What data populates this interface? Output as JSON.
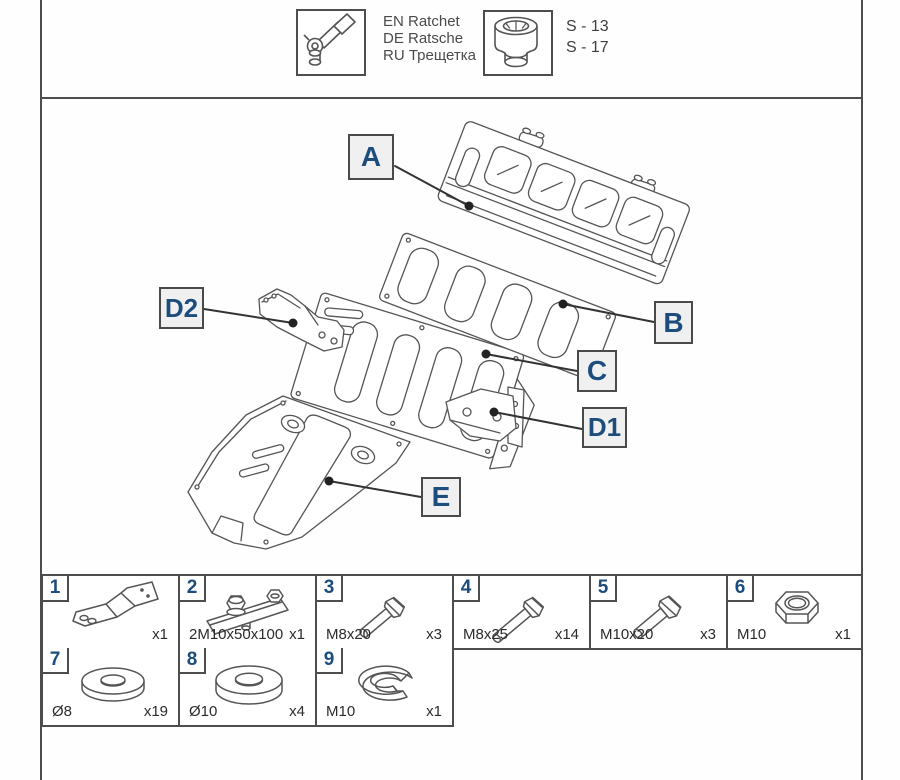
{
  "header": {
    "ratchet": {
      "en": "EN Ratchet",
      "de": "DE Ratsche",
      "ru": "RU Трещетка"
    },
    "socket": {
      "size_top": "S - 13",
      "size_bottom": "S - 17"
    }
  },
  "diagram": {
    "callouts": [
      {
        "text": "A"
      },
      {
        "text": "B"
      },
      {
        "text": "C"
      },
      {
        "text": "D1"
      },
      {
        "text": "D2"
      },
      {
        "text": "E"
      }
    ]
  },
  "parts_table": {
    "rows": [
      [
        {
          "num": "1",
          "label": "",
          "qty": "x1"
        },
        {
          "num": "2",
          "label": "2M10x50x100",
          "qty": "x1"
        },
        {
          "num": "3",
          "label": "M8x20",
          "qty": "x3"
        },
        {
          "num": "4",
          "label": "M8x25",
          "qty": "x14"
        },
        {
          "num": "5",
          "label": "M10x20",
          "qty": "x3"
        },
        {
          "num": "6",
          "label": "M10",
          "qty": "x1"
        }
      ],
      [
        {
          "num": "7",
          "label": "Ø8",
          "qty": "x19"
        },
        {
          "num": "8",
          "label": "Ø10",
          "qty": "x4"
        },
        {
          "num": "9",
          "label": "M10",
          "qty": "x1"
        }
      ]
    ]
  },
  "colors": {
    "accent": "#1d4d7c",
    "line": "#4d4d4d"
  }
}
